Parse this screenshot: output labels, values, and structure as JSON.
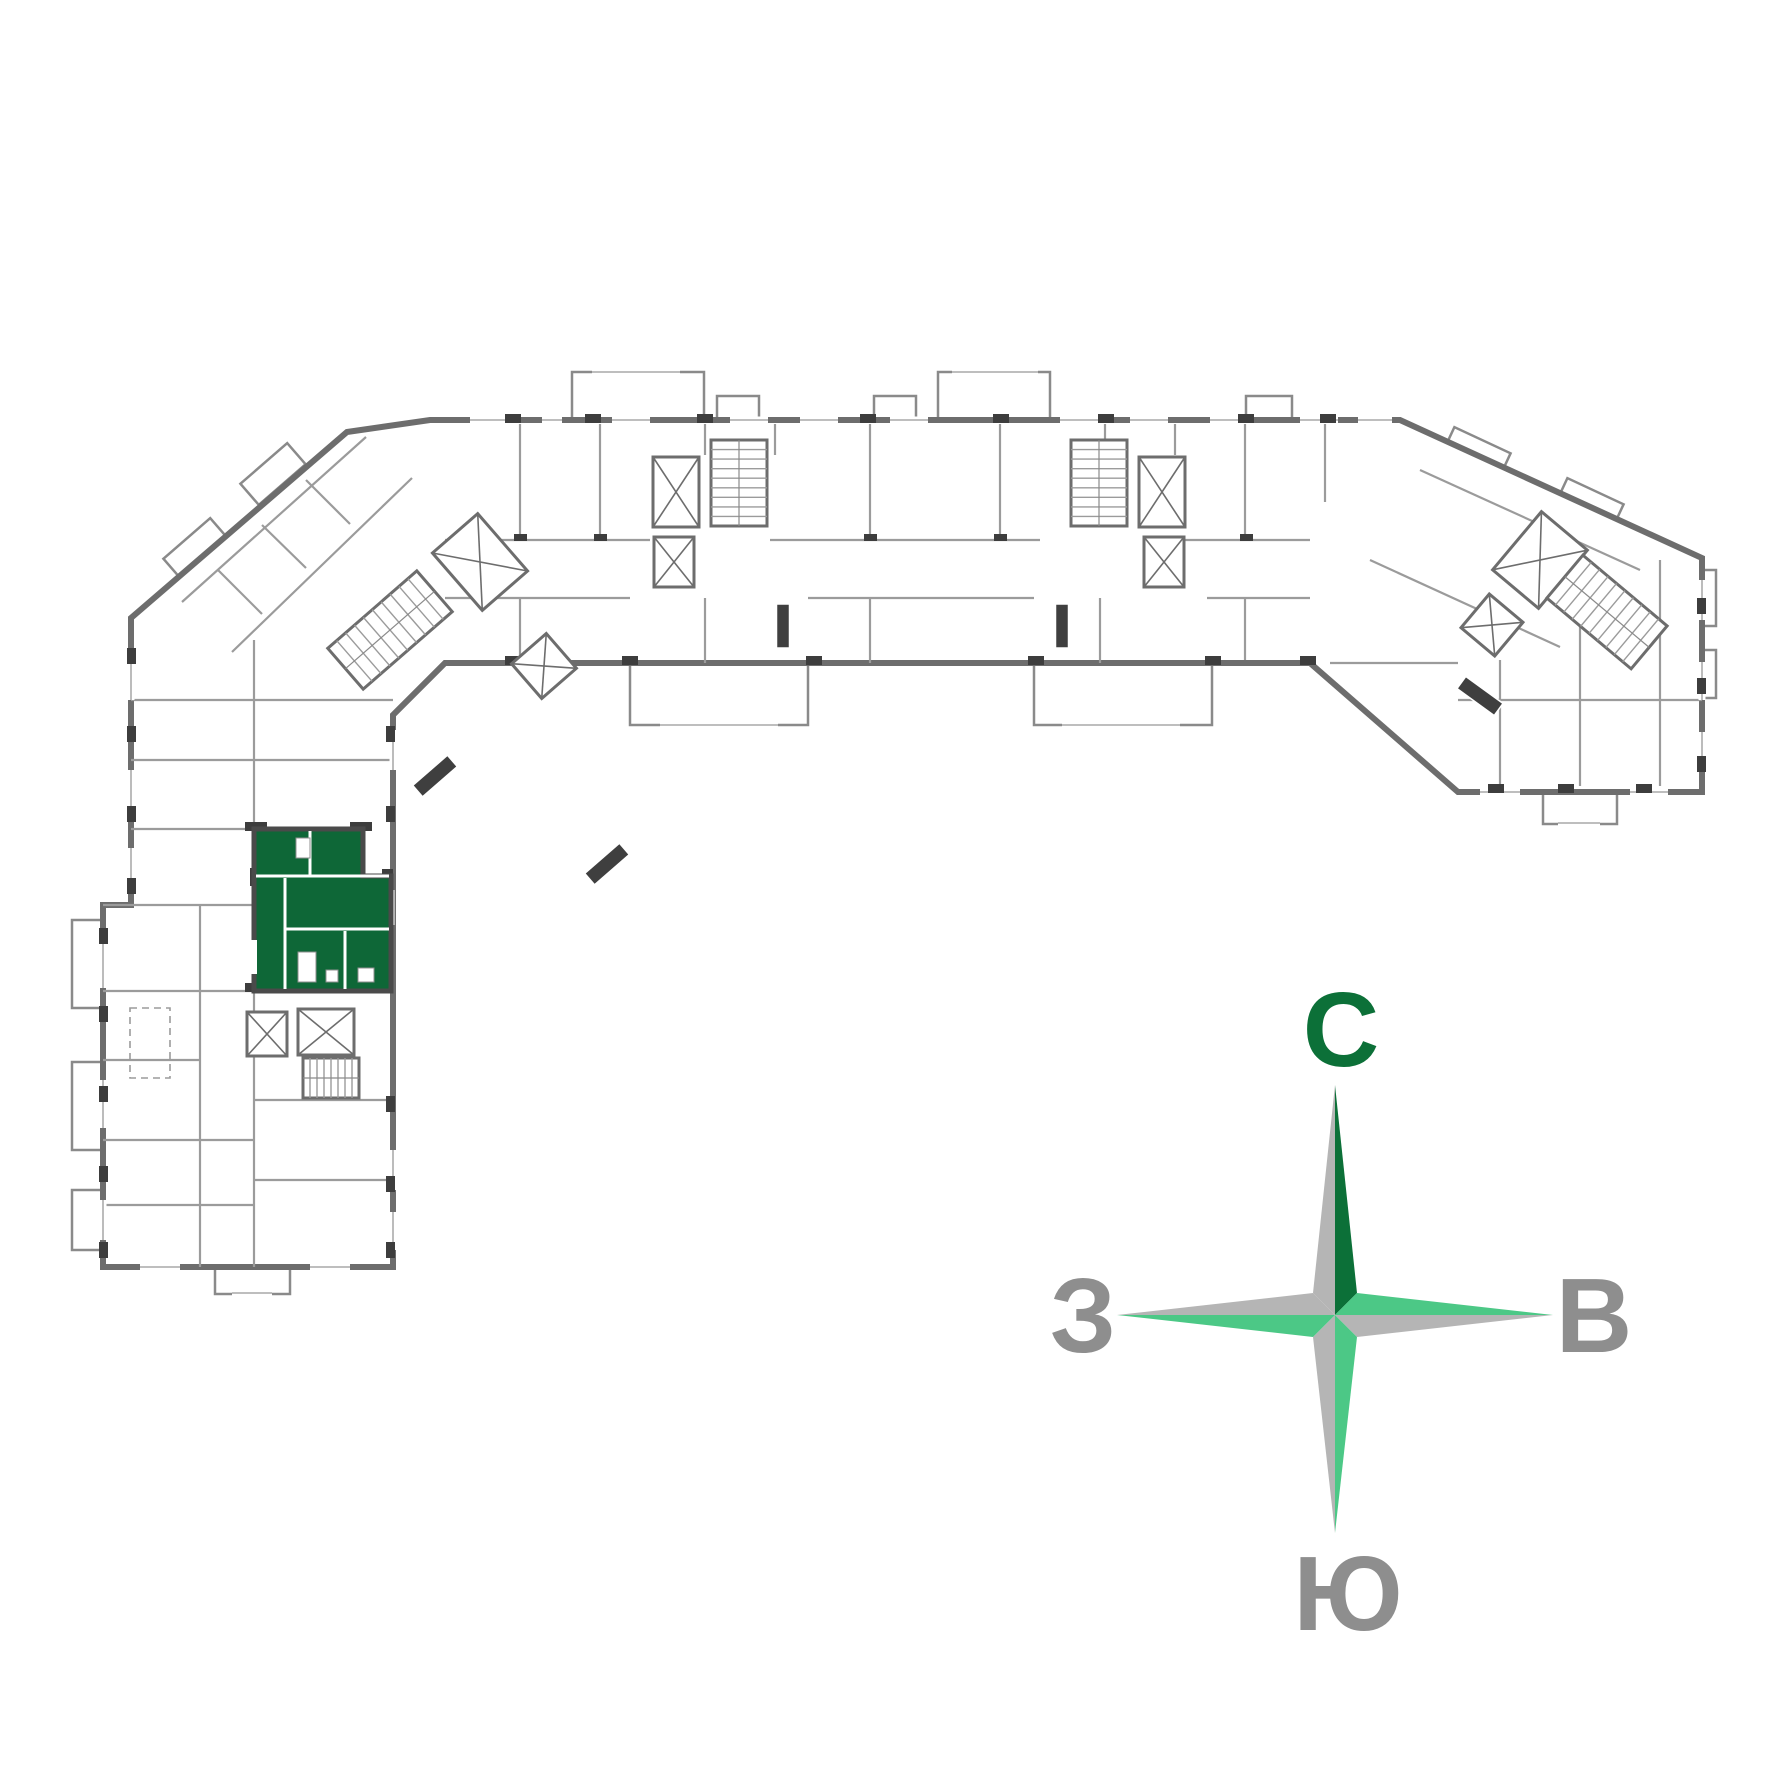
{
  "page": {
    "background": "#ffffff"
  },
  "floor_plan": {
    "canvas": {
      "width": 1776,
      "height": 1776
    },
    "palette": {
      "outer_wall": "#6d6d6d",
      "inner_wall": "#9b9b9b",
      "light_wall": "#8a8a8a",
      "pier": "#3d3d3d",
      "window_line": "#b4b4b4",
      "fixture_line": "#8f8f8f",
      "apartment_fill": "#0e6737",
      "apartment_stroke": "#4a4a4a"
    },
    "outline": [
      [
        430,
        420
      ],
      [
        1400,
        420
      ],
      [
        1702,
        558
      ],
      [
        1702,
        792
      ],
      [
        1458,
        792
      ],
      [
        1310,
        663
      ],
      [
        445,
        663
      ],
      [
        393,
        715
      ],
      [
        393,
        1267
      ],
      [
        103,
        1267
      ],
      [
        103,
        905
      ],
      [
        131,
        905
      ],
      [
        131,
        618
      ],
      [
        347,
        432
      ]
    ],
    "balconies": [
      {
        "x": 572,
        "y": 372,
        "w": 132,
        "h": 48
      },
      {
        "x": 938,
        "y": 372,
        "w": 112,
        "h": 48
      },
      {
        "x": 717,
        "y": 396,
        "w": 42,
        "h": 24
      },
      {
        "x": 874,
        "y": 396,
        "w": 42,
        "h": 24
      },
      {
        "x": 1246,
        "y": 396,
        "w": 46,
        "h": 24
      },
      {
        "x": 630,
        "y": 663,
        "w": 178,
        "h": 62
      },
      {
        "x": 1034,
        "y": 663,
        "w": 178,
        "h": 62
      },
      {
        "x": 215,
        "y": 1267,
        "w": 75,
        "h": 27
      },
      {
        "x": 1543,
        "y": 792,
        "w": 74,
        "h": 32
      },
      {
        "x": 72,
        "y": 920,
        "w": 31,
        "h": 88
      },
      {
        "x": 72,
        "y": 1062,
        "w": 31,
        "h": 88
      },
      {
        "x": 72,
        "y": 1190,
        "w": 31,
        "h": 60
      },
      {
        "x": 1702,
        "y": 570,
        "w": 14,
        "h": 56
      },
      {
        "x": 1702,
        "y": 650,
        "w": 14,
        "h": 48
      },
      {
        "cx": 196,
        "cy": 549,
        "w": 62,
        "h": 28,
        "rot": -41
      },
      {
        "cx": 273,
        "cy": 474,
        "w": 62,
        "h": 28,
        "rot": -41
      },
      {
        "cx": 1477,
        "cy": 452,
        "w": 62,
        "h": 26,
        "rot": 25
      },
      {
        "cx": 1590,
        "cy": 503,
        "w": 62,
        "h": 26,
        "rot": 25
      }
    ],
    "inner_walls": [
      [
        520,
        424,
        520,
        538
      ],
      [
        600,
        424,
        600,
        538
      ],
      [
        870,
        424,
        870,
        538
      ],
      [
        1000,
        424,
        1000,
        538
      ],
      [
        1245,
        424,
        1245,
        538
      ],
      [
        1325,
        424,
        1325,
        502
      ],
      [
        705,
        424,
        705,
        455
      ],
      [
        775,
        424,
        775,
        455
      ],
      [
        1105,
        424,
        1105,
        455
      ],
      [
        1175,
        424,
        1175,
        455
      ],
      [
        445,
        540,
        650,
        540
      ],
      [
        770,
        540,
        1040,
        540
      ],
      [
        1185,
        540,
        1310,
        540
      ],
      [
        445,
        598,
        630,
        598
      ],
      [
        808,
        598,
        1034,
        598
      ],
      [
        1207,
        598,
        1310,
        598
      ],
      [
        520,
        598,
        520,
        663
      ],
      [
        705,
        598,
        705,
        663
      ],
      [
        870,
        598,
        870,
        663
      ],
      [
        1100,
        598,
        1100,
        663
      ],
      [
        1245,
        598,
        1245,
        660
      ],
      [
        131,
        700,
        254,
        700
      ],
      [
        131,
        760,
        254,
        760
      ],
      [
        131,
        829,
        254,
        829
      ],
      [
        103,
        905,
        254,
        905
      ],
      [
        103,
        991,
        254,
        991
      ],
      [
        103,
        1060,
        200,
        1060
      ],
      [
        103,
        1140,
        254,
        1140
      ],
      [
        103,
        1205,
        254,
        1205
      ],
      [
        200,
        905,
        200,
        1267
      ],
      [
        254,
        640,
        254,
        829
      ],
      [
        254,
        991,
        254,
        1267
      ],
      [
        254,
        700,
        393,
        700
      ],
      [
        254,
        760,
        393,
        760
      ],
      [
        254,
        1100,
        393,
        1100
      ],
      [
        254,
        1180,
        393,
        1180
      ],
      [
        182,
        602,
        366,
        437
      ],
      [
        232,
        652,
        412,
        478
      ],
      [
        218,
        570,
        262,
        614
      ],
      [
        262,
        525,
        306,
        568
      ],
      [
        306,
        480,
        350,
        524
      ],
      [
        1420,
        470,
        1640,
        570
      ],
      [
        1370,
        560,
        1560,
        647
      ],
      [
        1500,
        660,
        1500,
        786
      ],
      [
        1580,
        600,
        1580,
        786
      ],
      [
        1660,
        560,
        1660,
        786
      ],
      [
        1458,
        700,
        1702,
        700
      ],
      [
        1330,
        663,
        1458,
        663
      ]
    ],
    "piers": [
      [
        505,
        414,
        16,
        9
      ],
      [
        585,
        414,
        16,
        9
      ],
      [
        697,
        414,
        16,
        9
      ],
      [
        860,
        414,
        16,
        9
      ],
      [
        993,
        414,
        16,
        9
      ],
      [
        1098,
        414,
        16,
        9
      ],
      [
        1238,
        414,
        16,
        9
      ],
      [
        1320,
        414,
        16,
        9
      ],
      [
        505,
        656,
        16,
        9
      ],
      [
        622,
        656,
        16,
        9
      ],
      [
        806,
        656,
        16,
        9
      ],
      [
        1028,
        656,
        16,
        9
      ],
      [
        1205,
        656,
        16,
        9
      ],
      [
        1300,
        656,
        16,
        9
      ],
      [
        99,
        928,
        9,
        16
      ],
      [
        99,
        1006,
        9,
        16
      ],
      [
        99,
        1086,
        9,
        16
      ],
      [
        99,
        1166,
        9,
        16
      ],
      [
        99,
        1242,
        9,
        16
      ],
      [
        127,
        648,
        9,
        16
      ],
      [
        127,
        726,
        9,
        16
      ],
      [
        127,
        806,
        9,
        16
      ],
      [
        127,
        878,
        9,
        16
      ],
      [
        386,
        726,
        9,
        16
      ],
      [
        386,
        806,
        9,
        16
      ],
      [
        386,
        1096,
        9,
        16
      ],
      [
        386,
        1176,
        9,
        16
      ],
      [
        386,
        1242,
        9,
        16
      ],
      [
        1697,
        598,
        9,
        16
      ],
      [
        1697,
        678,
        9,
        16
      ],
      [
        1697,
        756,
        9,
        16
      ],
      [
        1488,
        784,
        16,
        9
      ],
      [
        1558,
        784,
        16,
        9
      ],
      [
        1636,
        784,
        16,
        9
      ],
      [
        245,
        822,
        22,
        9
      ],
      [
        350,
        822,
        22,
        9
      ],
      [
        382,
        869,
        11,
        9
      ],
      [
        382,
        983,
        11,
        9
      ],
      [
        245,
        983,
        22,
        9
      ],
      [
        250,
        868,
        9,
        18
      ],
      [
        514,
        534,
        13,
        7
      ],
      [
        594,
        534,
        13,
        7
      ],
      [
        864,
        534,
        13,
        7
      ],
      [
        994,
        534,
        13,
        7
      ],
      [
        1240,
        534,
        13,
        7
      ]
    ],
    "windows": [
      [
        470,
        420,
        508,
        420
      ],
      [
        542,
        420,
        562,
        420
      ],
      [
        612,
        420,
        650,
        420
      ],
      [
        730,
        420,
        768,
        420
      ],
      [
        800,
        420,
        838,
        420
      ],
      [
        890,
        420,
        928,
        420
      ],
      [
        1060,
        420,
        1098,
        420
      ],
      [
        1130,
        420,
        1168,
        420
      ],
      [
        1210,
        420,
        1238,
        420
      ],
      [
        1300,
        420,
        1338,
        420
      ],
      [
        1358,
        420,
        1392,
        420
      ],
      [
        592,
        372,
        680,
        372
      ],
      [
        952,
        372,
        1038,
        372
      ],
      [
        103,
        940,
        103,
        988
      ],
      [
        103,
        1080,
        103,
        1128
      ],
      [
        103,
        1200,
        103,
        1240
      ],
      [
        131,
        660,
        131,
        700
      ],
      [
        131,
        770,
        131,
        810
      ],
      [
        131,
        848,
        131,
        888
      ],
      [
        393,
        730,
        393,
        770
      ],
      [
        393,
        1150,
        393,
        1190
      ],
      [
        393,
        1212,
        393,
        1250
      ],
      [
        1702,
        580,
        1702,
        620
      ],
      [
        1702,
        662,
        1702,
        700
      ],
      [
        1702,
        732,
        1702,
        770
      ],
      [
        140,
        1267,
        180,
        1267
      ],
      [
        310,
        1267,
        350,
        1267
      ],
      [
        232,
        1293,
        272,
        1293
      ],
      [
        1480,
        792,
        1520,
        792
      ],
      [
        1630,
        792,
        1668,
        792
      ],
      [
        1558,
        823,
        1600,
        823
      ],
      [
        660,
        725,
        778,
        725
      ],
      [
        1062,
        725,
        1180,
        725
      ],
      [
        391,
        890,
        391,
        925
      ],
      [
        363,
        991,
        385,
        991
      ]
    ],
    "cores": [
      {
        "type": "stairs",
        "cx": 390,
        "cy": 630,
        "w": 118,
        "h": 54,
        "rot": -41,
        "steps": 10
      },
      {
        "type": "elevator",
        "cx": 480,
        "cy": 562,
        "w": 60,
        "h": 76,
        "rot": -41
      },
      {
        "type": "elevator",
        "cx": 544,
        "cy": 666,
        "w": 46,
        "h": 46,
        "rot": -41
      },
      {
        "type": "elevator",
        "cx": 676,
        "cy": 492,
        "w": 46,
        "h": 70,
        "rot": 0
      },
      {
        "type": "elevator",
        "cx": 674,
        "cy": 562,
        "w": 40,
        "h": 50,
        "rot": 0
      },
      {
        "type": "stairs",
        "cx": 739,
        "cy": 483,
        "w": 56,
        "h": 86,
        "rot": 0,
        "steps": 9
      },
      {
        "type": "elevator",
        "cx": 1162,
        "cy": 492,
        "w": 46,
        "h": 70,
        "rot": 0
      },
      {
        "type": "elevator",
        "cx": 1164,
        "cy": 562,
        "w": 40,
        "h": 50,
        "rot": 0
      },
      {
        "type": "stairs",
        "cx": 1099,
        "cy": 483,
        "w": 56,
        "h": 86,
        "rot": 0,
        "steps": 9
      },
      {
        "type": "elevator",
        "cx": 1540,
        "cy": 560,
        "w": 60,
        "h": 76,
        "rot": 40
      },
      {
        "type": "stairs",
        "cx": 1607,
        "cy": 612,
        "w": 110,
        "h": 56,
        "rot": 40,
        "steps": 10
      },
      {
        "type": "elevator",
        "cx": 1492,
        "cy": 625,
        "w": 44,
        "h": 44,
        "rot": 40
      },
      {
        "type": "elevator",
        "cx": 267,
        "cy": 1034,
        "w": 40,
        "h": 44,
        "rot": 0
      },
      {
        "type": "elevator",
        "cx": 326,
        "cy": 1032,
        "w": 56,
        "h": 46,
        "rot": 0
      },
      {
        "type": "stairs",
        "cx": 331,
        "cy": 1078,
        "w": 56,
        "h": 40,
        "rot": 0,
        "steps": 8
      }
    ],
    "door_blocks": [
      {
        "cx": 607,
        "cy": 864,
        "w": 46,
        "h": 15,
        "rot": -41
      },
      {
        "cx": 435,
        "cy": 776,
        "w": 46,
        "h": 15,
        "rot": -41
      },
      {
        "cx": 1480,
        "cy": 696,
        "w": 46,
        "h": 15,
        "rot": 36
      },
      {
        "cx": 783,
        "cy": 626,
        "w": 13,
        "h": 44,
        "rot": 0
      },
      {
        "cx": 1062,
        "cy": 626,
        "w": 13,
        "h": 44,
        "rot": 0
      }
    ],
    "dashed_rects": [
      {
        "x": 130,
        "y": 1008,
        "w": 40,
        "h": 70
      }
    ],
    "apartment": {
      "name": "selected-apartment",
      "polygon": [
        [
          254,
          829
        ],
        [
          363,
          829
        ],
        [
          363,
          876
        ],
        [
          391,
          876
        ],
        [
          391,
          991
        ],
        [
          254,
          991
        ]
      ],
      "dividers": [
        [
          310,
          831,
          310,
          876
        ],
        [
          256,
          876,
          389,
          876
        ],
        [
          285,
          878,
          285,
          989
        ],
        [
          285,
          929,
          389,
          929
        ],
        [
          345,
          931,
          345,
          989
        ]
      ],
      "fixtures": [
        [
          296,
          838,
          14,
          20
        ],
        [
          298,
          952,
          18,
          30
        ],
        [
          326,
          970,
          12,
          12
        ],
        [
          358,
          968,
          16,
          14
        ]
      ],
      "door_gaps": [
        [
          251,
          940,
          6,
          34
        ]
      ]
    },
    "compass": {
      "cx": 1335,
      "cy": 1315,
      "tips": {
        "north": 1085,
        "east": 1553,
        "south": 1533,
        "west": 1117
      },
      "waist": 22,
      "colors": {
        "north_left": "#b5b5b5",
        "north_right": "#0c7038",
        "east_top": "#4cc886",
        "east_bottom": "#b5b5b5",
        "south_left": "#b5b5b5",
        "south_right": "#4cc886",
        "west_top": "#b5b5b5",
        "west_bottom": "#4cc886"
      },
      "labels": [
        {
          "id": "north",
          "text": "С",
          "x": 1341,
          "y": 1066,
          "color": "#0c7038",
          "size": 106
        },
        {
          "id": "west",
          "text": "З",
          "x": 1083,
          "y": 1352,
          "color": "#8e8e8e",
          "size": 106
        },
        {
          "id": "east",
          "text": "В",
          "x": 1594,
          "y": 1352,
          "color": "#8e8e8e",
          "size": 106
        },
        {
          "id": "south",
          "text": "Ю",
          "x": 1348,
          "y": 1630,
          "color": "#8e8e8e",
          "size": 106
        }
      ]
    }
  }
}
